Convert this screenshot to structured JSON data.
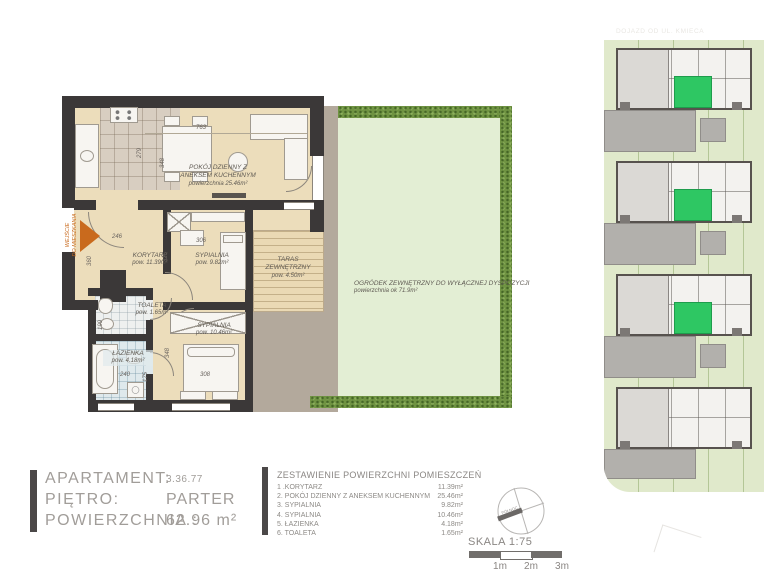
{
  "floor_plan": {
    "entrance": {
      "line1": "WEJŚCIE",
      "line2": "DO MIESZKANIA"
    },
    "rooms": {
      "living": {
        "line1": "POKÓJ DZIENNY Z",
        "line2": "ANEKSEM KUCHENNYM",
        "area": "powierzchnia 25.46m²"
      },
      "hall": {
        "name": "KORYTARZ",
        "area": "pow. 11.39m²"
      },
      "bedroom1": {
        "name": "SYPIALNIA",
        "area": "pow. 9.82m²"
      },
      "bedroom2": {
        "name": "SYPIALNIA",
        "area": "pow. 10.46m²"
      },
      "toilet": {
        "name": "TOALETA",
        "area": "pow. 1.65m²"
      },
      "bathroom": {
        "name": "ŁAZIENKA",
        "area": "pow. 4.18m²"
      },
      "terrace": {
        "line1": "TARAS",
        "line2": "ZEWNĘTRZNY",
        "area": "pow. 4.50m²"
      },
      "garden": {
        "name": "OGRÓDEK ZEWNĘTRZNY DO WYŁĄCZNEJ DYSPOZYCJI",
        "area": "powierzchnia ok 71.9m²"
      }
    },
    "dimensions": [
      "763",
      "279",
      "348",
      "246",
      "306",
      "325",
      "360",
      "199",
      "240",
      "175",
      "348",
      "308"
    ]
  },
  "info": {
    "apartment_label": "APARTAMENT:",
    "apartment_value": "3.36.77",
    "floor_label": "PIĘTRO:",
    "floor_value": "PARTER",
    "area_label": "POWIERZCHNIA :",
    "area_value": "62.96 m²"
  },
  "room_schedule": {
    "title": "ZESTAWIENIE POWIERZCHNI POMIESZCZEŃ",
    "rows": [
      {
        "name": "1 .KORYTARZ",
        "area": "11.39m²"
      },
      {
        "name": "2. POKÓJ DZIENNY Z ANEKSEM KUCHENNYM",
        "area": "25.46m²"
      },
      {
        "name": "3. SYPIALNIA",
        "area": "9.82m²"
      },
      {
        "name": "4. SYPIALNIA",
        "area": "10.46m²"
      },
      {
        "name": "5. ŁAZIENKA",
        "area": "4.18m²"
      },
      {
        "name": "6. TOALETA",
        "area": "1.65m²"
      }
    ]
  },
  "scale": {
    "label": "SKALA 1:75",
    "compass_label": "PÓŁNOC",
    "ticks": [
      "1m",
      "2m",
      "3m"
    ]
  },
  "site_map": {
    "road_label": "DOJAZD OD UL. KMIECA"
  },
  "colors": {
    "wall": "#3b3838",
    "floor": "#ecddbb",
    "garden": "#e3eed4",
    "hedge": "#6f9342",
    "map_highlight": "#2ec763",
    "entrance_arrow": "#c96a1d"
  }
}
